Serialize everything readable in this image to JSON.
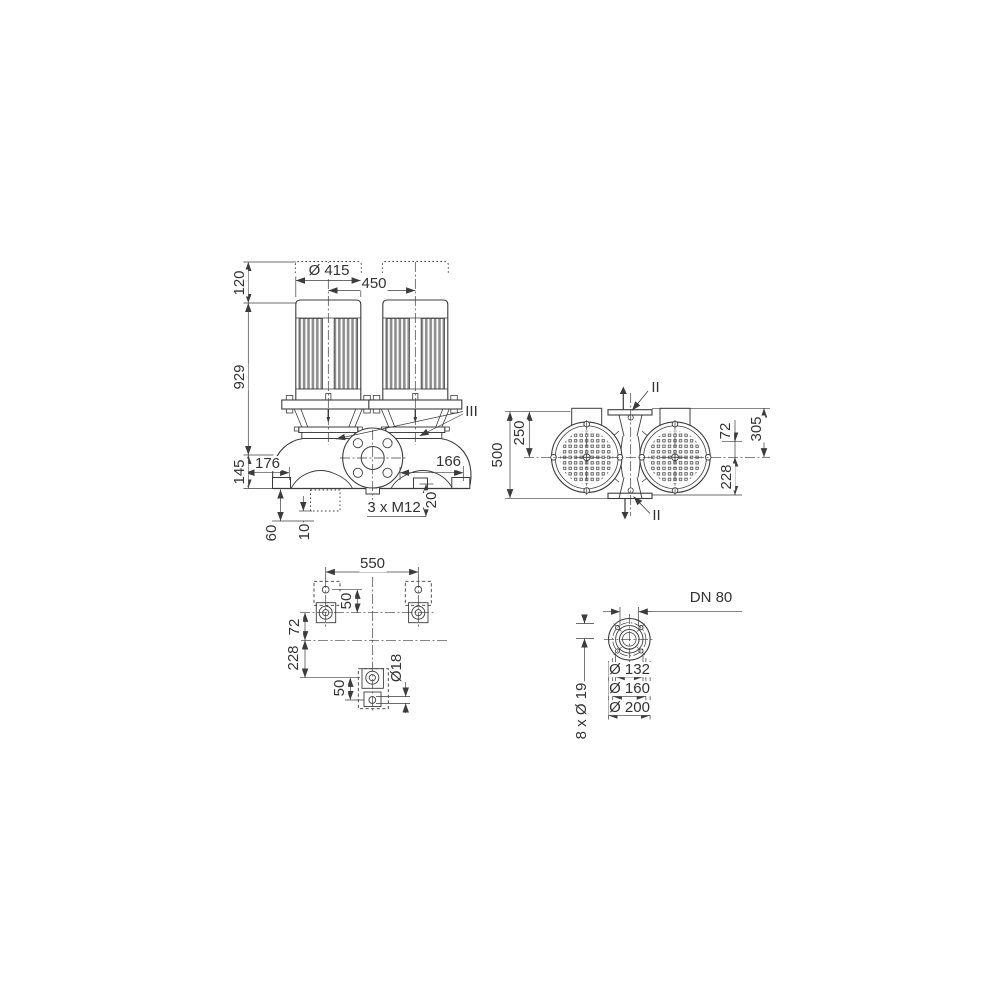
{
  "colors": {
    "line": "#3c3c3c",
    "text": "#333333",
    "fins_fill": "#8e8e8e"
  },
  "front_view": {
    "clearance_height": "120",
    "motor_height": "929",
    "base_height": "145",
    "motor_diameter": "Ø 415",
    "motor_spacing": "450",
    "offset_left": "176",
    "offset_right": "166",
    "foot_thread_depth": "20",
    "foot_threads": "3 x M12",
    "drain_offset": "60",
    "drain_offset2": "10",
    "section_label": "III"
  },
  "top_view": {
    "overall_width": "500",
    "center_to_edge": "250",
    "axis_offset": "72",
    "flange_to_axis": "305",
    "axis_to_foot": "228",
    "port_label_top": "II",
    "port_label_bottom": "II"
  },
  "foundation_view": {
    "bolt_spacing": "550",
    "hole_spacing_top": "50",
    "axis_offset": "72",
    "axis_to_front_foot": "228",
    "hole_spacing_bottom": "50",
    "hole_diameter": "Ø18"
  },
  "flange_view": {
    "nominal_diameter": "DN 80",
    "raised_face_diameter": "Ø 132",
    "bolt_circle_diameter": "Ø 160",
    "outer_diameter": "Ø 200",
    "bolt_holes": "8 x Ø 19"
  }
}
